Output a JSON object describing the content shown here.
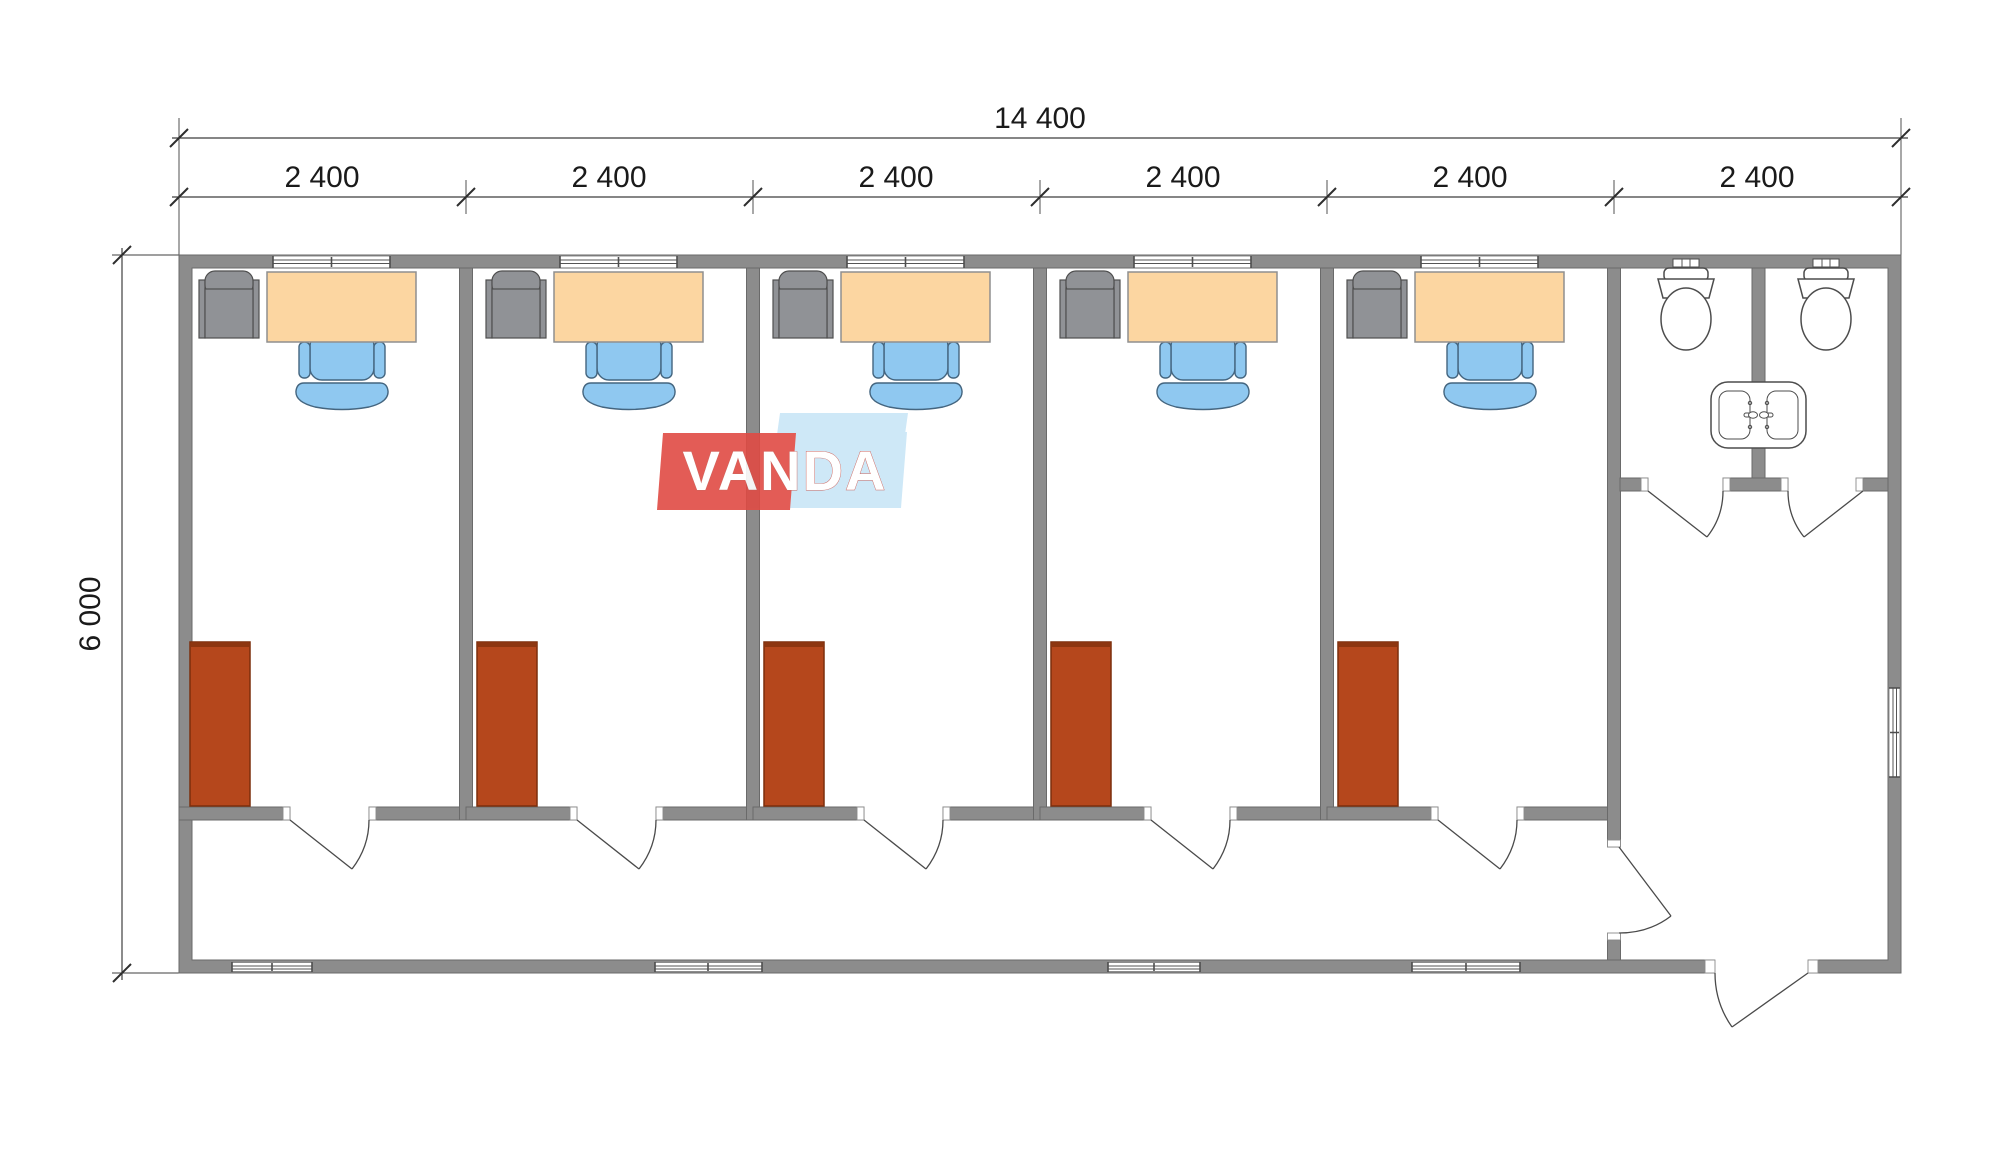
{
  "watermark": {
    "text": "VANDA"
  },
  "dimensions": {
    "total_width": "14 400",
    "height": "6 000",
    "modules": [
      "2 400",
      "2 400",
      "2 400",
      "2 400",
      "2 400",
      "2 400"
    ]
  },
  "colors": {
    "wall": "#8c8c8c",
    "wall_edge": "#6a6a6a",
    "desk": "#fcd6a1",
    "desk_edge": "#8f8f8f",
    "chair": "#8fc8f0",
    "chair_edge": "#44657f",
    "cabinet": "#909296",
    "cabinet_edge": "#4f4f4f",
    "wardrobe": "#b5471c",
    "wardrobe_edge": "#7c2f0c",
    "fixture_edge": "#4d4d4d",
    "line": "#3f3f3f",
    "text": "#1a1a1a",
    "logo_red": "#e04b44",
    "logo_blue": "#c9e6f7",
    "logo_text": "#ffffff"
  },
  "symbols": {
    "office_furniture": [
      "storage-cabinet",
      "desk",
      "office-chair",
      "wardrobe"
    ],
    "sanitary_fixtures": [
      "toilet",
      "toilet",
      "double-washbasin"
    ],
    "openings": [
      "window",
      "door-swing"
    ]
  }
}
